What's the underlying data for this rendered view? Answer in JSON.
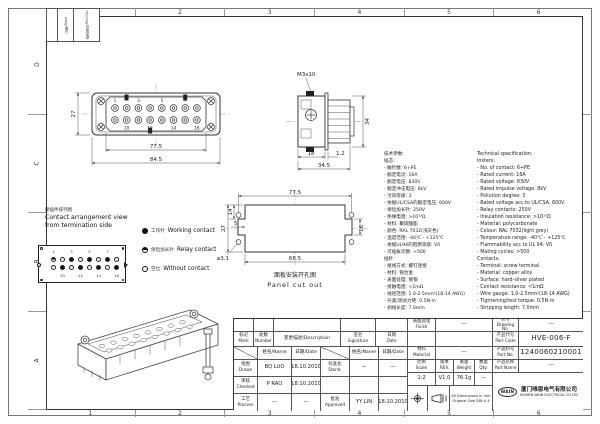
{
  "border": {
    "top": [
      "1",
      "2",
      "3",
      "4",
      "5",
      "6"
    ],
    "bottom": [
      "1",
      "2",
      "3",
      "4",
      "5",
      "6"
    ],
    "left": [
      "D",
      "C",
      "B",
      "A"
    ]
  },
  "corner_labels": [
    "日期/Date",
    "更改单号/Rev.Doc"
  ],
  "front_view": {
    "pins_top": [
      "1",
      "3",
      "5",
      "7"
    ],
    "pins_bottom": [
      "10",
      "12",
      "14",
      "16"
    ],
    "dim_inner": "77.5",
    "dim_outer": "84.5",
    "dim_height": "27"
  },
  "side_view": {
    "thread": "M3x10",
    "dim_depth": "18",
    "dim_gap": "1.2",
    "dim_total": "34.5",
    "dim_height": "34"
  },
  "cutout": {
    "dim_top": "77.5",
    "dim_bottom": "68.5",
    "dim_left": "27",
    "dim_left_inner": "14",
    "dim_notch": "5",
    "hole": "⌀3.1",
    "dim_right": "16",
    "caption_cn": "面板安装开孔图",
    "caption_en": "Panel cut out"
  },
  "arrangement": {
    "title_cn": "接插件排列图",
    "title_en1": "Contact arrangement view",
    "title_en2": "from termination side",
    "nums_top": [
      "1",
      "3",
      "5",
      "7"
    ],
    "nums_bottom": [
      "10",
      "12",
      "14",
      "16"
    ],
    "pattern_top": [
      "relay",
      "empty",
      "work",
      "empty",
      "work",
      "empty",
      "work",
      "empty"
    ],
    "pattern_bottom": [
      "empty",
      "work",
      "empty",
      "work",
      "empty",
      "work",
      "empty",
      "work"
    ]
  },
  "legend": [
    {
      "type": "work",
      "cn": "工作针",
      "en": "Working contact"
    },
    {
      "type": "relay",
      "cn": "保险加长针",
      "en": "Relay contact"
    },
    {
      "type": "none",
      "cn": "空位",
      "en": "Without contact"
    }
  ],
  "spec": {
    "cn": [
      "技术参数:",
      "插芯:",
      "- 触针数: 6+PE",
      "- 额定电流: 16A",
      "- 额定电压: 830V",
      "- 额定冲击电压: 8kV",
      "- 污染等级: 3",
      "- 依据UL/CSA的额定电压: 600V",
      "- 保险加长针: 250V",
      "- 绝缘电阻: >10¹⁰Ω",
      "- 材料: 聚碳酸酯",
      "- 颜色: RAL 7032(浅灰色)",
      "- 温度范围: -40℃ - +125℃",
      "- 依据UL94的阻燃等级: V0",
      "- 可插拔次数: >500",
      "插针:",
      "- 接线方式: 螺钉连接",
      "- 材料: 铜合金",
      "- 表面处理: 镀银",
      "- 接触电阻: <1mΩ",
      "- 线径范围: 1.0-2.5mm²(18-14 AWG)",
      "- 拧紧/测试力矩: 0.5N·m",
      "- 剥线长度: 7.0mm"
    ],
    "en": [
      "Technical specification:",
      "Insters:",
      "- No. of contact: 6+PE",
      "- Rated current: 16A",
      "- Rated voltage: 830V",
      "- Rated impulse voltage: 8kV",
      "- Pollution degree: 3",
      "- Rated voltage acc.to UL/CSA: 600V",
      "- Relay contacts: 250V",
      "- Insulation resistance: >10¹⁰Ω",
      "- Material: polycarbonate",
      "- Colour: RAL 7032(light grey)",
      "- Temperature range: -40℃ - +125℃",
      "- Flammability acc.to UL 94: V0",
      "- Mating cycles: >500",
      "Contacts:",
      "- Terminal: screw terminal",
      "- Material: copper alloy",
      "- Surface: hard-silver plated",
      "- Contact resistance: <1mΩ",
      "- Wire gauge: 1.0-2.5mm²(18-14 AWG)",
      "- Tightening/test torque: 0.5N·m",
      "- Stripping length: 7.0mm"
    ]
  },
  "titleblock": {
    "rev_headers": {
      "mark_cn": "标记",
      "mark_en": "Mark",
      "num_cn": "处数",
      "num_en": "Number",
      "desc": "变更描述/Description",
      "sig_cn": "签名",
      "sig_en": "Signature",
      "date_cn": "日期",
      "date_en": "Date"
    },
    "name_hdr": "姓名/Name",
    "date_hdr": "日期/Date",
    "rows": [
      {
        "role_cn": "绘图",
        "role_en": "Drawn",
        "name": "BQ LUO",
        "date": "18.10.2010",
        "role2_cn": "标准化",
        "role2_en": "Stand.",
        "name2": "—",
        "date2": "—"
      },
      {
        "role_cn": "审核",
        "role_en": "Checked",
        "name": "P RAO",
        "date": "18.10.2010",
        "role2_cn": "",
        "role2_en": "",
        "name2": "",
        "date2": ""
      },
      {
        "role_cn": "工艺",
        "role_en": "Process",
        "name": "—",
        "date": "—",
        "role2_cn": "批准",
        "role2_en": "Approved",
        "name2": "YY LIN",
        "date2": "18.10.2010"
      }
    ],
    "finish_cn": "表面处理",
    "finish_en": "Finish",
    "finish_val": "—",
    "material_cn": "材料",
    "material_en": "Material",
    "material_val": "—",
    "scale_cn": "比例",
    "scale_en": "Scale",
    "scale_val": "1:2",
    "rev_cn": "版本",
    "rev_en": "REV.",
    "rev_val": "V1.0",
    "weight_cn": "重量",
    "weight_en": "Weight",
    "weight_val": "76.1g",
    "qty_cn": "数量",
    "qty_en": "Qty.",
    "qty_val": "—",
    "drawingno_cn": "图号",
    "drawingno_en": "Drawing No.",
    "drawingno_val": "—",
    "partcode_cn": "产品代号",
    "partcode_en": "Part Code",
    "partcode_val": "HVE-006-F",
    "partno_cn": "产品料号",
    "partno_en": "Part No.",
    "partno_val": "1240060210001",
    "partname_cn": "产品名称",
    "partname_en": "Part Name",
    "partname_val": "—",
    "note1": "All Dimensions in mm",
    "note2": "Original Size DIN A 4",
    "logo": "WAIN",
    "company_cn": "厦门唯恩电气有限公司",
    "company_en": "XIAMEN WAIN ELECTRICAL CO.LTD"
  }
}
